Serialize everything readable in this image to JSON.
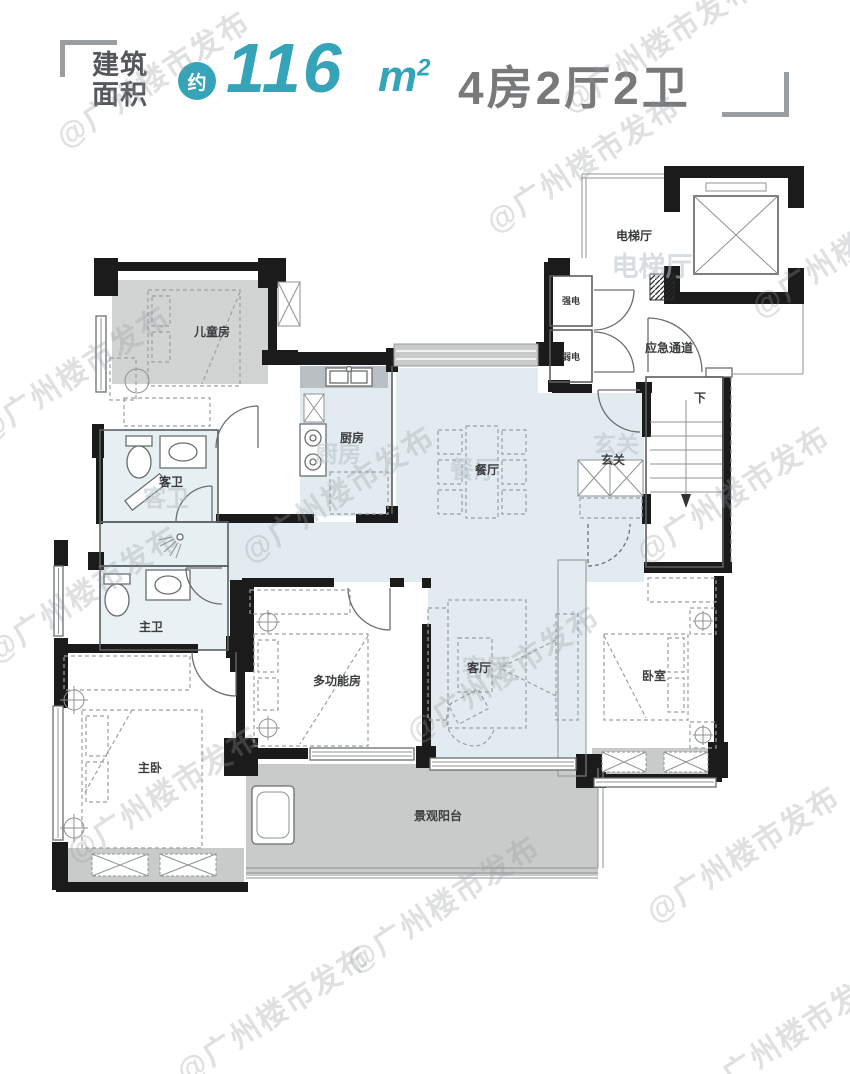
{
  "header": {
    "area_label_line1": "建筑",
    "area_label_line2": "面积",
    "approx": "约",
    "value": "116",
    "unit": "m",
    "unit_exp": "2",
    "layout": "4房2厅2卫"
  },
  "watermark": {
    "text": "@广州楼市发布"
  },
  "rooms": {
    "children_room": "儿童房",
    "kitchen": "厨房",
    "dining": "餐厅",
    "entry": "玄关",
    "elevator_hall": "电梯厅",
    "emergency_passage": "应急通道",
    "strong_electric": "强电",
    "weak_electric": "弱电",
    "stairs_down": "下",
    "guest_bath": "客卫",
    "master_bath": "主卫",
    "multi_room": "多功能房",
    "living": "客厅",
    "bedroom": "卧室",
    "master_bedroom": "主卧",
    "balcony": "景观阳台"
  },
  "colors": {
    "accent_teal": "#35a4b8",
    "header_gray": "#77797b",
    "wall_black": "#1b1b1b",
    "room_blue": "#e2ecf0",
    "room_gray": "#c9cbca"
  }
}
